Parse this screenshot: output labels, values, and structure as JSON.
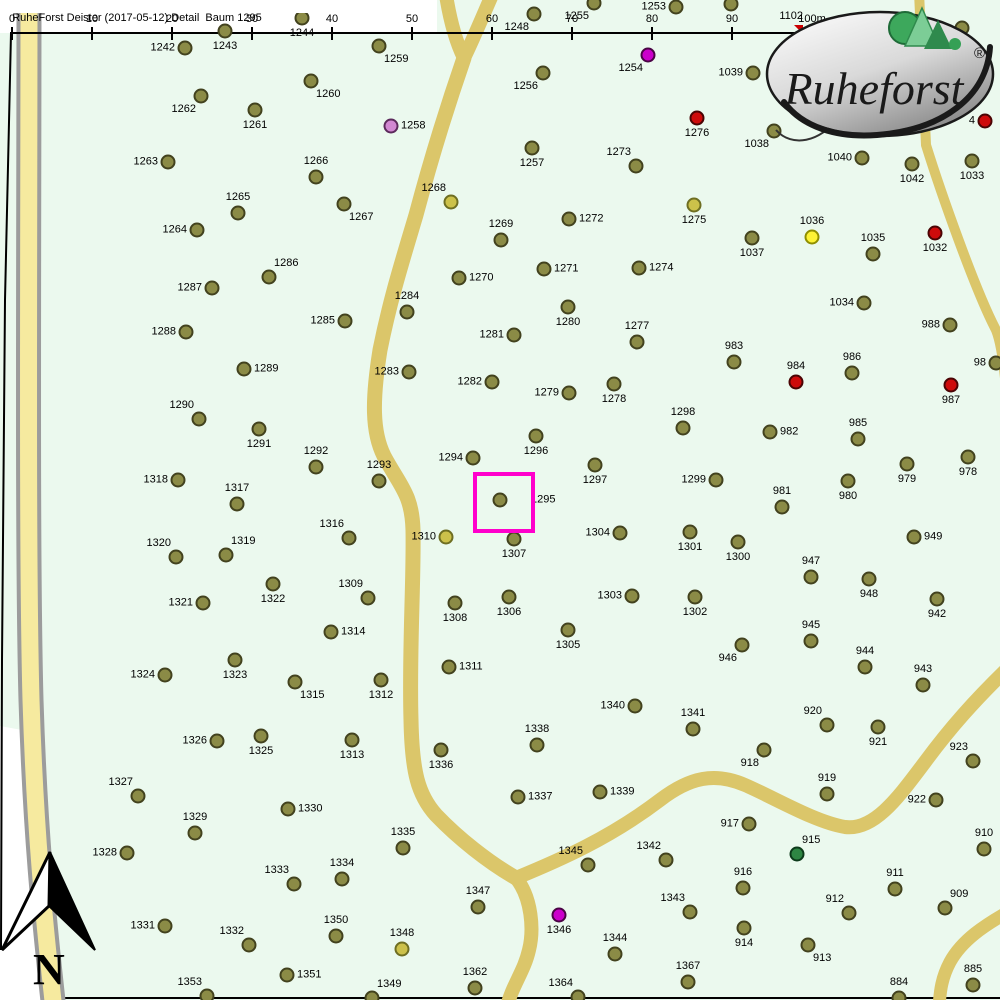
{
  "header": {
    "title": "RuheForst Deister (2017-05-12) Detail  Baum 1295"
  },
  "ruler": {
    "ticks": [
      {
        "label": "0",
        "x": 12
      },
      {
        "label": "10",
        "x": 92
      },
      {
        "label": "20",
        "x": 172
      },
      {
        "label": "30",
        "x": 252
      },
      {
        "label": "40",
        "x": 332
      },
      {
        "label": "50",
        "x": 412
      },
      {
        "label": "60",
        "x": 492
      },
      {
        "label": "70",
        "x": 572
      },
      {
        "label": "80",
        "x": 652
      },
      {
        "label": "90",
        "x": 732
      },
      {
        "label": "100m",
        "x": 812
      }
    ],
    "marker": {
      "label": "1102",
      "x": 803,
      "arrow_x": 794,
      "arrow_y": 25,
      "color": "#CC0000"
    }
  },
  "logo": {
    "brand": "Ruheforst",
    "registered": "®"
  },
  "compass": {
    "label": "N"
  },
  "selection": {
    "tree_id": "1295",
    "x": 473,
    "y": 472,
    "width": 54,
    "height": 53,
    "color": "#FF00CC"
  },
  "colors": {
    "olive": {
      "fill": "#8B8B46",
      "stroke": "#42421E"
    },
    "dark_yellow": {
      "fill": "#CCC14A",
      "stroke": "#6E6E22"
    },
    "yellow": {
      "fill": "#FDF335",
      "stroke": "#8F8F00"
    },
    "red": {
      "fill": "#CE0B0B",
      "stroke": "#4A0404"
    },
    "magenta": {
      "fill": "#CB00CB",
      "stroke": "#4A0445"
    },
    "plum": {
      "fill": "#D288D2",
      "stroke": "#5C2A5C"
    },
    "green": {
      "fill": "#2E8643",
      "stroke": "#0D3B1B"
    }
  },
  "trees": [
    {
      "id": "1242",
      "x": 185,
      "y": 48,
      "s": "l"
    },
    {
      "id": "1243",
      "x": 225,
      "y": 31,
      "s": "b"
    },
    {
      "id": "1244",
      "x": 302,
      "y": 18,
      "s": "b"
    },
    {
      "id": "1248",
      "x": 534,
      "y": 14,
      "s": "bl"
    },
    {
      "id": "1255",
      "x": 594,
      "y": 3,
      "s": "bl"
    },
    {
      "id": "1253",
      "x": 676,
      "y": 7,
      "s": "l"
    },
    {
      "id": "",
      "x": 731,
      "y": 4,
      "s": "b"
    },
    {
      "id": "1254",
      "x": 648,
      "y": 55,
      "s": "bl",
      "c": "magenta"
    },
    {
      "id": "",
      "x": 962,
      "y": 28,
      "s": "b"
    },
    {
      "id": "1259",
      "x": 379,
      "y": 46,
      "s": "br"
    },
    {
      "id": "1260",
      "x": 311,
      "y": 81,
      "s": "br"
    },
    {
      "id": "1261",
      "x": 255,
      "y": 110,
      "s": "b"
    },
    {
      "id": "1262",
      "x": 201,
      "y": 96,
      "s": "bl"
    },
    {
      "id": "1256",
      "x": 543,
      "y": 73,
      "s": "bl"
    },
    {
      "id": "1257",
      "x": 532,
      "y": 148,
      "s": "b"
    },
    {
      "id": "1258",
      "x": 391,
      "y": 126,
      "s": "r",
      "c": "plum"
    },
    {
      "id": "1263",
      "x": 168,
      "y": 162,
      "s": "l"
    },
    {
      "id": "1266",
      "x": 316,
      "y": 177,
      "s": "a"
    },
    {
      "id": "1273",
      "x": 636,
      "y": 166,
      "s": "al"
    },
    {
      "id": "1276",
      "x": 697,
      "y": 118,
      "s": "b",
      "c": "red"
    },
    {
      "id": "1039",
      "x": 753,
      "y": 73,
      "s": "l"
    },
    {
      "id": "1038",
      "x": 774,
      "y": 131,
      "s": "bl"
    },
    {
      "id": "4",
      "x": 985,
      "y": 121,
      "s": "l",
      "c": "red"
    },
    {
      "id": "1040",
      "x": 862,
      "y": 158,
      "s": "l"
    },
    {
      "id": "1042",
      "x": 912,
      "y": 164,
      "s": "b"
    },
    {
      "id": "1033",
      "x": 972,
      "y": 161,
      "s": "b"
    },
    {
      "id": "1275",
      "x": 694,
      "y": 205,
      "s": "b",
      "c": "dark_yellow"
    },
    {
      "id": "1036",
      "x": 812,
      "y": 237,
      "s": "a",
      "c": "yellow"
    },
    {
      "id": "1037",
      "x": 752,
      "y": 238,
      "s": "b"
    },
    {
      "id": "1035",
      "x": 873,
      "y": 254,
      "s": "a"
    },
    {
      "id": "1032",
      "x": 935,
      "y": 233,
      "s": "b",
      "c": "red"
    },
    {
      "id": "1265",
      "x": 238,
      "y": 213,
      "s": "a"
    },
    {
      "id": "1264",
      "x": 197,
      "y": 230,
      "s": "l"
    },
    {
      "id": "1267",
      "x": 344,
      "y": 204,
      "s": "br"
    },
    {
      "id": "1268",
      "x": 451,
      "y": 202,
      "s": "al",
      "c": "dark_yellow"
    },
    {
      "id": "1269",
      "x": 501,
      "y": 240,
      "s": "a"
    },
    {
      "id": "1272",
      "x": 569,
      "y": 219,
      "s": "r"
    },
    {
      "id": "1271",
      "x": 544,
      "y": 269,
      "s": "r"
    },
    {
      "id": "1274",
      "x": 639,
      "y": 268,
      "s": "r"
    },
    {
      "id": "1270",
      "x": 459,
      "y": 278,
      "s": "r"
    },
    {
      "id": "1286",
      "x": 269,
      "y": 277,
      "s": "ar"
    },
    {
      "id": "1287",
      "x": 212,
      "y": 288,
      "s": "l"
    },
    {
      "id": "1284",
      "x": 407,
      "y": 312,
      "s": "a"
    },
    {
      "id": "1280",
      "x": 568,
      "y": 307,
      "s": "b"
    },
    {
      "id": "1281",
      "x": 514,
      "y": 335,
      "s": "l"
    },
    {
      "id": "1277",
      "x": 637,
      "y": 342,
      "s": "a"
    },
    {
      "id": "1285",
      "x": 345,
      "y": 321,
      "s": "l"
    },
    {
      "id": "1288",
      "x": 186,
      "y": 332,
      "s": "l"
    },
    {
      "id": "1034",
      "x": 864,
      "y": 303,
      "s": "l"
    },
    {
      "id": "988",
      "x": 950,
      "y": 325,
      "s": "l"
    },
    {
      "id": "983",
      "x": 734,
      "y": 362,
      "s": "a"
    },
    {
      "id": "986",
      "x": 852,
      "y": 373,
      "s": "a"
    },
    {
      "id": "984",
      "x": 796,
      "y": 382,
      "s": "a",
      "c": "red"
    },
    {
      "id": "987",
      "x": 951,
      "y": 385,
      "s": "b",
      "c": "red"
    },
    {
      "id": "98",
      "x": 996,
      "y": 363,
      "s": "l"
    },
    {
      "id": "985",
      "x": 858,
      "y": 439,
      "s": "a"
    },
    {
      "id": "982",
      "x": 770,
      "y": 432,
      "s": "r"
    },
    {
      "id": "1298",
      "x": 683,
      "y": 428,
      "s": "a"
    },
    {
      "id": "1278",
      "x": 614,
      "y": 384,
      "s": "b"
    },
    {
      "id": "1279",
      "x": 569,
      "y": 393,
      "s": "l"
    },
    {
      "id": "1282",
      "x": 492,
      "y": 382,
      "s": "l"
    },
    {
      "id": "1283",
      "x": 409,
      "y": 372,
      "s": "l"
    },
    {
      "id": "1289",
      "x": 244,
      "y": 369,
      "s": "r"
    },
    {
      "id": "1290",
      "x": 199,
      "y": 419,
      "s": "al"
    },
    {
      "id": "1291",
      "x": 259,
      "y": 429,
      "s": "b"
    },
    {
      "id": "1292",
      "x": 316,
      "y": 467,
      "s": "a"
    },
    {
      "id": "1296",
      "x": 536,
      "y": 436,
      "s": "b"
    },
    {
      "id": "1294",
      "x": 473,
      "y": 458,
      "s": "l"
    },
    {
      "id": "1297",
      "x": 595,
      "y": 465,
      "s": "b"
    },
    {
      "id": "1293",
      "x": 379,
      "y": 481,
      "s": "a"
    },
    {
      "id": "1295",
      "x": 500,
      "y": 500,
      "s": "rr"
    },
    {
      "id": "1310",
      "x": 446,
      "y": 537,
      "s": "l",
      "c": "dark_yellow"
    },
    {
      "id": "1307",
      "x": 514,
      "y": 539,
      "s": "b"
    },
    {
      "id": "1304",
      "x": 620,
      "y": 533,
      "s": "l"
    },
    {
      "id": "1316",
      "x": 349,
      "y": 538,
      "s": "al"
    },
    {
      "id": "1318",
      "x": 178,
      "y": 480,
      "s": "l"
    },
    {
      "id": "1317",
      "x": 237,
      "y": 504,
      "s": "a"
    },
    {
      "id": "1320",
      "x": 176,
      "y": 557,
      "s": "al"
    },
    {
      "id": "1319",
      "x": 226,
      "y": 555,
      "s": "ar"
    },
    {
      "id": "1322",
      "x": 273,
      "y": 584,
      "s": "b"
    },
    {
      "id": "1321",
      "x": 203,
      "y": 603,
      "s": "l"
    },
    {
      "id": "1309",
      "x": 368,
      "y": 598,
      "s": "al"
    },
    {
      "id": "1308",
      "x": 455,
      "y": 603,
      "s": "b"
    },
    {
      "id": "1306",
      "x": 509,
      "y": 597,
      "s": "b"
    },
    {
      "id": "1303",
      "x": 632,
      "y": 596,
      "s": "l"
    },
    {
      "id": "1305",
      "x": 568,
      "y": 630,
      "s": "b"
    },
    {
      "id": "1314",
      "x": 331,
      "y": 632,
      "s": "r"
    },
    {
      "id": "1299",
      "x": 716,
      "y": 480,
      "s": "l"
    },
    {
      "id": "1301",
      "x": 690,
      "y": 532,
      "s": "b"
    },
    {
      "id": "1300",
      "x": 738,
      "y": 542,
      "s": "b"
    },
    {
      "id": "1302",
      "x": 695,
      "y": 597,
      "s": "b"
    },
    {
      "id": "980",
      "x": 848,
      "y": 481,
      "s": "b"
    },
    {
      "id": "981",
      "x": 782,
      "y": 507,
      "s": "a"
    },
    {
      "id": "979",
      "x": 907,
      "y": 464,
      "s": "b"
    },
    {
      "id": "978",
      "x": 968,
      "y": 457,
      "s": "b"
    },
    {
      "id": "949",
      "x": 914,
      "y": 537,
      "s": "r"
    },
    {
      "id": "947",
      "x": 811,
      "y": 577,
      "s": "a"
    },
    {
      "id": "948",
      "x": 869,
      "y": 579,
      "s": "b"
    },
    {
      "id": "942",
      "x": 937,
      "y": 599,
      "s": "b"
    },
    {
      "id": "945",
      "x": 811,
      "y": 641,
      "s": "a"
    },
    {
      "id": "946",
      "x": 742,
      "y": 645,
      "s": "bl"
    },
    {
      "id": "944",
      "x": 865,
      "y": 667,
      "s": "a"
    },
    {
      "id": "943",
      "x": 923,
      "y": 685,
      "s": "a"
    },
    {
      "id": "1323",
      "x": 235,
      "y": 660,
      "s": "b"
    },
    {
      "id": "1324",
      "x": 165,
      "y": 675,
      "s": "l"
    },
    {
      "id": "1315",
      "x": 295,
      "y": 682,
      "s": "br"
    },
    {
      "id": "1326",
      "x": 217,
      "y": 741,
      "s": "l"
    },
    {
      "id": "1325",
      "x": 261,
      "y": 736,
      "s": "b"
    },
    {
      "id": "1327",
      "x": 138,
      "y": 796,
      "s": "al"
    },
    {
      "id": "1330",
      "x": 288,
      "y": 809,
      "s": "r"
    },
    {
      "id": "1329",
      "x": 195,
      "y": 833,
      "s": "a"
    },
    {
      "id": "1328",
      "x": 127,
      "y": 853,
      "s": "l"
    },
    {
      "id": "1333",
      "x": 294,
      "y": 884,
      "s": "al"
    },
    {
      "id": "1334",
      "x": 342,
      "y": 879,
      "s": "a"
    },
    {
      "id": "1331",
      "x": 165,
      "y": 926,
      "s": "l"
    },
    {
      "id": "1332",
      "x": 249,
      "y": 945,
      "s": "al"
    },
    {
      "id": "1350",
      "x": 336,
      "y": 936,
      "s": "a"
    },
    {
      "id": "1351",
      "x": 287,
      "y": 975,
      "s": "r"
    },
    {
      "id": "1353",
      "x": 207,
      "y": 996,
      "s": "al"
    },
    {
      "id": "1349",
      "x": 372,
      "y": 998,
      "s": "ar"
    },
    {
      "id": "1311",
      "x": 449,
      "y": 667,
      "s": "r"
    },
    {
      "id": "1312",
      "x": 381,
      "y": 680,
      "s": "b"
    },
    {
      "id": "1313",
      "x": 352,
      "y": 740,
      "s": "b"
    },
    {
      "id": "1336",
      "x": 441,
      "y": 750,
      "s": "b"
    },
    {
      "id": "1338",
      "x": 537,
      "y": 745,
      "s": "a"
    },
    {
      "id": "1340",
      "x": 635,
      "y": 706,
      "s": "l"
    },
    {
      "id": "1337",
      "x": 518,
      "y": 797,
      "s": "r"
    },
    {
      "id": "1339",
      "x": 600,
      "y": 792,
      "s": "r"
    },
    {
      "id": "1335",
      "x": 403,
      "y": 848,
      "s": "a"
    },
    {
      "id": "1345",
      "x": 588,
      "y": 865,
      "s": "al"
    },
    {
      "id": "1342",
      "x": 666,
      "y": 860,
      "s": "al"
    },
    {
      "id": "1347",
      "x": 478,
      "y": 907,
      "s": "a"
    },
    {
      "id": "1346",
      "x": 559,
      "y": 915,
      "s": "b",
      "c": "magenta"
    },
    {
      "id": "1348",
      "x": 402,
      "y": 949,
      "s": "a",
      "c": "dark_yellow"
    },
    {
      "id": "1344",
      "x": 615,
      "y": 954,
      "s": "a"
    },
    {
      "id": "1362",
      "x": 475,
      "y": 988,
      "s": "a"
    },
    {
      "id": "1364",
      "x": 578,
      "y": 997,
      "s": "al"
    },
    {
      "id": "1343",
      "x": 690,
      "y": 912,
      "s": "al"
    },
    {
      "id": "1341",
      "x": 693,
      "y": 729,
      "s": "a"
    },
    {
      "id": "920",
      "x": 827,
      "y": 725,
      "s": "al"
    },
    {
      "id": "921",
      "x": 878,
      "y": 727,
      "s": "b"
    },
    {
      "id": "918",
      "x": 764,
      "y": 750,
      "s": "bl"
    },
    {
      "id": "923",
      "x": 973,
      "y": 761,
      "s": "al"
    },
    {
      "id": "919",
      "x": 827,
      "y": 794,
      "s": "a"
    },
    {
      "id": "922",
      "x": 936,
      "y": 800,
      "s": "l"
    },
    {
      "id": "917",
      "x": 749,
      "y": 824,
      "s": "l"
    },
    {
      "id": "910",
      "x": 984,
      "y": 849,
      "s": "a"
    },
    {
      "id": "915",
      "x": 797,
      "y": 854,
      "s": "ar",
      "c": "green"
    },
    {
      "id": "916",
      "x": 743,
      "y": 888,
      "s": "a"
    },
    {
      "id": "911",
      "x": 895,
      "y": 889,
      "s": "a"
    },
    {
      "id": "912",
      "x": 849,
      "y": 913,
      "s": "al"
    },
    {
      "id": "909",
      "x": 945,
      "y": 908,
      "s": "ar"
    },
    {
      "id": "914",
      "x": 744,
      "y": 928,
      "s": "b"
    },
    {
      "id": "913",
      "x": 808,
      "y": 945,
      "s": "br"
    },
    {
      "id": "1367",
      "x": 688,
      "y": 982,
      "s": "a"
    },
    {
      "id": "884",
      "x": 899,
      "y": 998,
      "s": "a"
    },
    {
      "id": "885",
      "x": 973,
      "y": 985,
      "s": "a"
    }
  ]
}
